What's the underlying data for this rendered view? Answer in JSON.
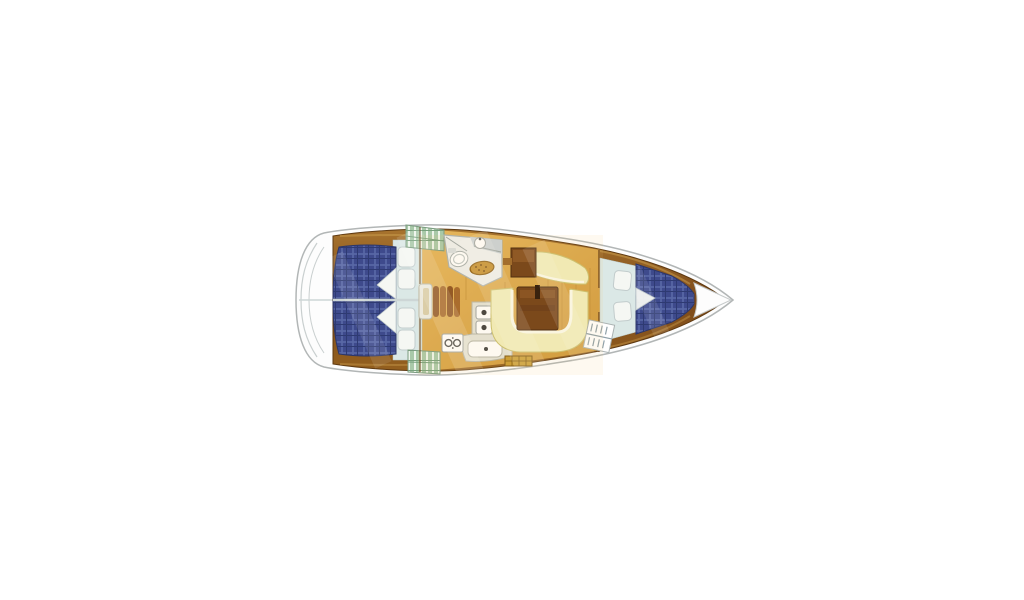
{
  "page": {
    "title": "Sailboat interior layout floor plan, top view, bow pointing right",
    "background": "#ffffff"
  },
  "regions": {
    "aft_cabin_port": "Aft double cabin (top)",
    "aft_cabin_starboard": "Aft double cabin (bottom)",
    "companionway": "Companionway steps",
    "head": "Head / bathroom with toilet and sink",
    "galley": "Galley with stove and sinks",
    "salon": "Salon with U-shaped settee, straight settee and tables",
    "forward_cabin": "Forward V-berth cabin",
    "bow": "Bow tip"
  },
  "colors": {
    "hull_fill": "#fdfdfd",
    "hull_outline": "#b2b6b6",
    "stern_line": "#c9cfcf",
    "trim_hi": "#a8742e",
    "trim_dark": "#7c4a1a",
    "trim_mid": "#94601f",
    "sole_hi": "#e6b75e",
    "sole_lo": "#cd9638",
    "grain": "#b9852f",
    "berth_navy": "#3e4a8c",
    "berth_grid_light": "#5868a6",
    "berth_grid_dark": "#2e3a72",
    "pillow_white": "#f5f7f3",
    "pillow_edge": "#c2cccc",
    "floor_blue": "#dbe8e6",
    "settee_cream": "#f1eebb",
    "settee_edge": "#fbfbec",
    "table_wood": "#6e3b12",
    "table_streak": "#8a5322",
    "head_floor": "#eef0f0",
    "counter_gray": "#c9d2d8",
    "galley_counter": "#e3e3d8",
    "fixture_white": "#ffffff",
    "fixture_line": "#9aa0a0",
    "mat_gold": "#c18a28",
    "mat_edge": "#8a5c12",
    "locker_green": "#a9c9a9",
    "locker_line": "#76a07c",
    "hatch_gold": "#c89a30",
    "hatch_edge": "#7a5410",
    "divider": "#cdd6d6",
    "bulkhead": "#5a3210",
    "step_wood": "#8a4f1e",
    "step_wood2": "#a26426",
    "step_frame": "#eceee9"
  }
}
